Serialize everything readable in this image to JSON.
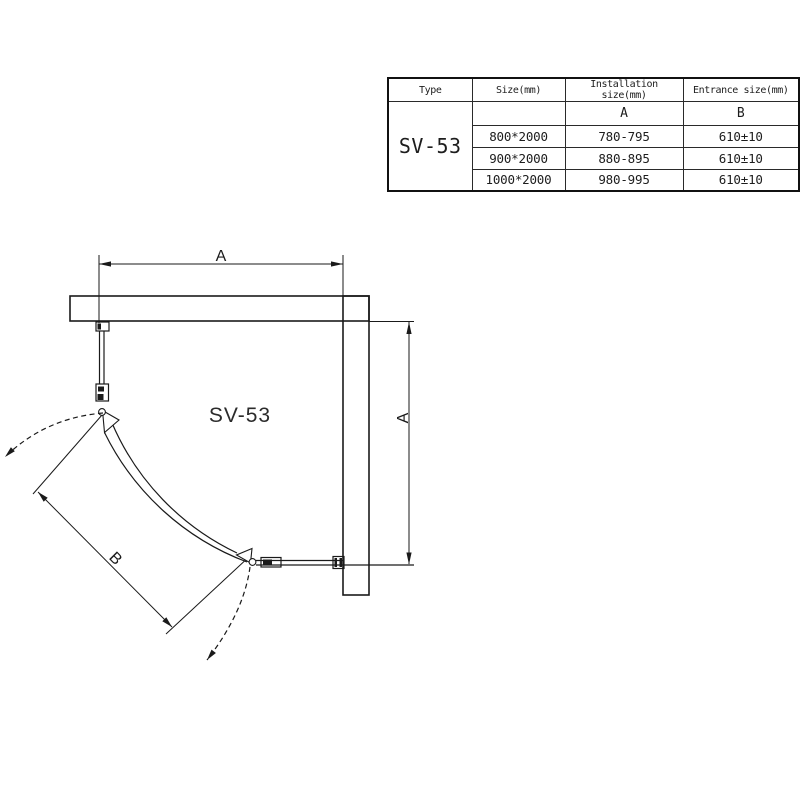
{
  "table": {
    "headers": {
      "type": "Type",
      "size": "Size(mm)",
      "installation": "Installation size(mm)",
      "entrance": "Entrance size(mm)"
    },
    "sub_headers": {
      "installation": "A",
      "entrance": "B"
    },
    "type_value": "SV-53",
    "rows": [
      {
        "size": "800*2000",
        "installation": "780-795",
        "entrance": "610±10"
      },
      {
        "size": "900*2000",
        "installation": "880-895",
        "entrance": "610±10"
      },
      {
        "size": "1000*2000",
        "installation": "980-995",
        "entrance": "610±10"
      }
    ]
  },
  "drawing": {
    "model_label": "SV-53",
    "dim_top": "A",
    "dim_right": "A",
    "dim_entrance": "B",
    "line_color": "#1a1a1a"
  }
}
